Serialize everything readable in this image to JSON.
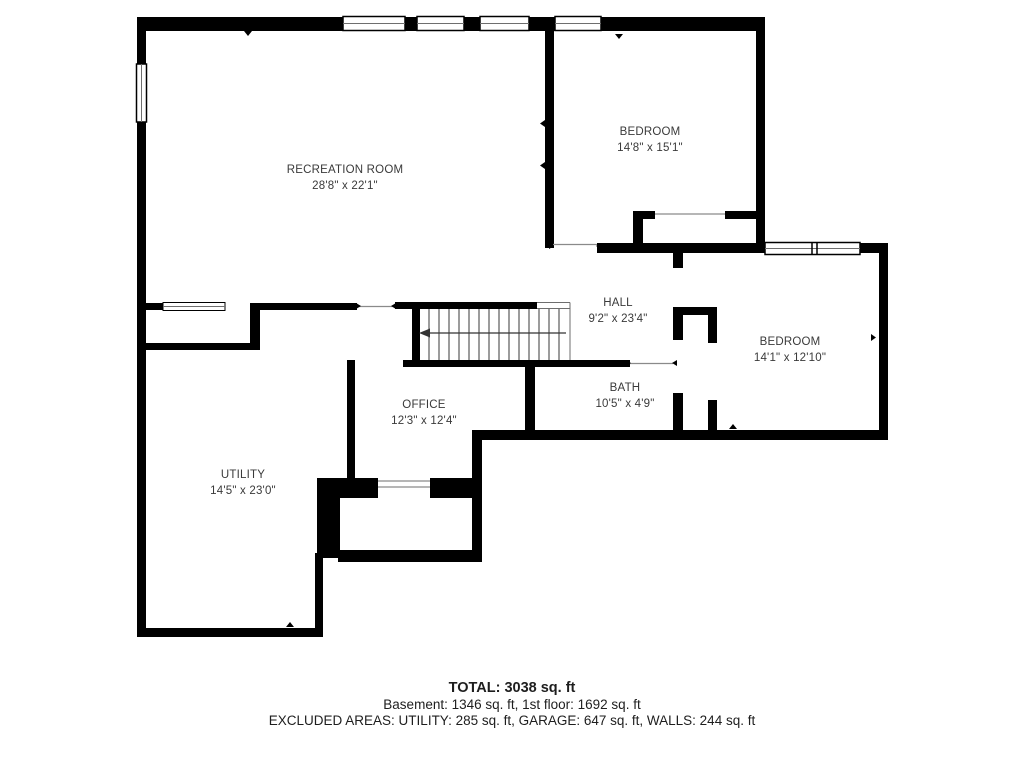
{
  "floor_plan": {
    "level_label": "Basement floor plan",
    "rooms": [
      {
        "name": "RECREATION ROOM",
        "dimensions": "28'8\" x 22'1\""
      },
      {
        "name": "BEDROOM",
        "dimensions": "14'8\" x 15'1\""
      },
      {
        "name": "HALL",
        "dimensions": "9'2\" x 23'4\""
      },
      {
        "name": "BEDROOM",
        "dimensions": "14'1\" x 12'10\""
      },
      {
        "name": "OFFICE",
        "dimensions": "12'3\" x 12'4\""
      },
      {
        "name": "BATH",
        "dimensions": "10'5\" x 4'9\""
      },
      {
        "name": "UTILITY",
        "dimensions": "14'5\" x 23'0\""
      }
    ],
    "summary": {
      "total": "TOTAL: 3038 sq. ft",
      "floors": "Basement: 1346 sq. ft, 1st floor: 1692 sq. ft",
      "excluded_areas": "EXCLUDED AREAS: UTILITY: 285 sq. ft, GARAGE: 647 sq. ft, WALLS: 244 sq. ft"
    },
    "colors": {
      "wall": "#000000",
      "background": "#ffffff",
      "label_text": "#3a3a3a",
      "summary_text": "#1e1e1e",
      "thin_line": "#6e6e6e"
    }
  }
}
